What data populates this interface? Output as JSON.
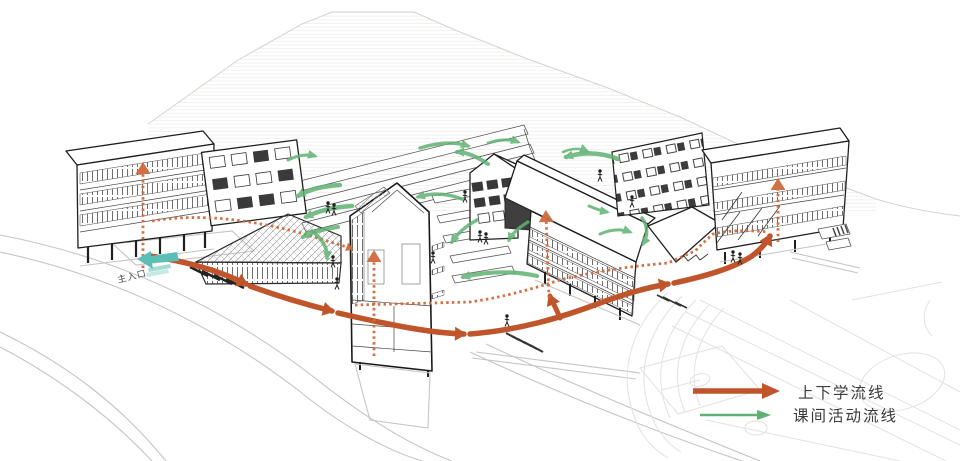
{
  "page": {
    "width": 960,
    "height": 461,
    "background": "#ffffff"
  },
  "diagram": {
    "kind": "architectural axonometric circulation diagram",
    "subject": "school campus with mountain backdrop, entry plaza and sports field"
  },
  "labels": {
    "main_entrance": "主入口"
  },
  "legend": {
    "items": [
      {
        "id": "commute",
        "label": "上下学流线",
        "style": "thick-solid-arrow",
        "color": "#c0552b"
      },
      {
        "id": "recess-activity",
        "label": "课间活动流线",
        "style": "thin-arrow",
        "color": "#5fb273"
      }
    ]
  },
  "colors": {
    "commute": "#c0552b",
    "commute_dash": "#cf6a3c",
    "activity": "#5fb273",
    "entrance": "#5bbfb5",
    "ink": "#1f1f1f",
    "mid": "#555555",
    "light": "#c7c5c2",
    "faint": "#e4e2df",
    "text": "#3a3a3a"
  }
}
